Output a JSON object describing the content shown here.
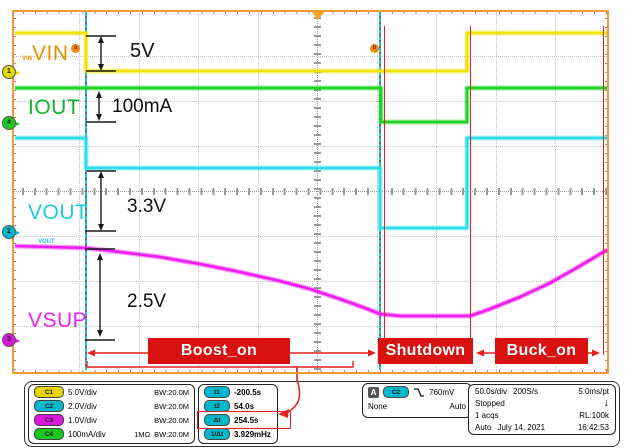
{
  "plot": {
    "channel_labels": {
      "c1": "VIN",
      "c4": "IOUT",
      "c2": "VOUT",
      "c3": "VSUP"
    },
    "tiny_labels": {
      "vin": "VIN",
      "vout": "VOUT"
    },
    "markers": {
      "a": "a",
      "b": "b"
    },
    "ground_markers": {
      "c1": "1",
      "c2": "2",
      "c3": "3",
      "c4": "4"
    },
    "measurements": {
      "vin_delta": "5V",
      "iout_delta": "100mA",
      "vout_delta": "3.3V",
      "vsup_delta": "2.5V"
    },
    "regions": {
      "boost": "Boost_on",
      "shutdown": "Shutdown",
      "buck": "Buck_on"
    },
    "colors": {
      "vin": "#f2e400",
      "iout": "#1ed321",
      "vout": "#2bdde8",
      "vsup": "#ee1cee",
      "annotation_red": "#e62020",
      "border_orange": "#ef9b3a"
    }
  },
  "waveforms": [
    {
      "name": "VIN",
      "color": "#f0e300",
      "points": [
        [
          3,
          23
        ],
        [
          74,
          23
        ],
        [
          74,
          61
        ],
        [
          455,
          61
        ],
        [
          455,
          23
        ],
        [
          596,
          23
        ]
      ]
    },
    {
      "name": "IOUT",
      "color": "#1ed321",
      "points": [
        [
          3,
          78
        ],
        [
          369,
          78
        ],
        [
          369,
          112
        ],
        [
          455,
          112
        ],
        [
          455,
          78
        ],
        [
          596,
          78
        ]
      ]
    },
    {
      "name": "VOUT",
      "color": "#2bdde8",
      "points": [
        [
          3,
          128
        ],
        [
          74,
          128
        ],
        [
          74,
          158
        ],
        [
          368,
          158
        ],
        [
          368,
          218
        ],
        [
          455,
          218
        ],
        [
          455,
          128
        ],
        [
          596,
          128
        ]
      ]
    },
    {
      "name": "VSUP",
      "color": "#ee1cee",
      "points": [
        [
          3,
          236
        ],
        [
          74,
          238
        ],
        [
          108,
          242
        ],
        [
          148,
          247
        ],
        [
          188,
          254
        ],
        [
          228,
          262
        ],
        [
          268,
          271
        ],
        [
          298,
          279
        ],
        [
          328,
          289
        ],
        [
          353,
          298
        ],
        [
          368,
          304
        ],
        [
          378,
          305
        ],
        [
          388,
          306
        ],
        [
          458,
          306
        ],
        [
          478,
          299
        ],
        [
          508,
          287
        ],
        [
          538,
          273
        ],
        [
          568,
          256
        ],
        [
          593,
          241
        ],
        [
          596,
          240
        ]
      ]
    }
  ],
  "geometry": {
    "cursors_x": [
      74,
      368
    ],
    "red_lines": [
      {
        "x": 372,
        "y1": 16,
        "y2": 345
      },
      {
        "x": 458,
        "y1": 16,
        "y2": 345
      },
      {
        "x": 591,
        "y1": 16,
        "y2": 345
      }
    ],
    "measures": [
      {
        "x": 89,
        "y1": 26,
        "y2": 61,
        "bars": [
          [
            74,
            104,
            26
          ],
          [
            74,
            104,
            61
          ]
        ]
      },
      {
        "x": 87,
        "y1": 81,
        "y2": 111,
        "bars": [
          [
            74,
            104,
            112
          ]
        ]
      },
      {
        "x": 89,
        "y1": 161,
        "y2": 221,
        "bars": [
          [
            75,
            104,
            161
          ],
          [
            73,
            104,
            221
          ]
        ]
      },
      {
        "x": 88,
        "y1": 243,
        "y2": 327,
        "bars": [
          [
            73,
            103,
            239
          ],
          [
            73,
            103,
            330
          ]
        ]
      }
    ],
    "red_arrows": [
      {
        "x1": 75,
        "x2": 364,
        "y": 343
      },
      {
        "x1": 464,
        "x2": 588,
        "y": 343
      }
    ],
    "bracket": {
      "pts": [
        [
          75,
          351
        ],
        [
          75,
          357
        ],
        [
          341,
          357
        ],
        [
          341,
          351
        ]
      ],
      "pointer": [
        [
          285,
          357
        ],
        [
          285,
          364
        ]
      ]
    }
  },
  "readouts": {
    "channels": [
      {
        "badge": "C1",
        "scale": "5.0V/div",
        "impedance": "",
        "bw": "BW:20.0M"
      },
      {
        "badge": "C2",
        "scale": "2.0V/div",
        "impedance": "",
        "bw": "BW:20.0M"
      },
      {
        "badge": "C3",
        "scale": "1.0V/div",
        "impedance": "",
        "bw": "BW:20.0M"
      },
      {
        "badge": "C4",
        "scale": "100mA/div",
        "impedance": "1MΩ",
        "bw": "BW:20.0M"
      }
    ],
    "cursors": [
      {
        "badge": "t1",
        "value": "-200.5s"
      },
      {
        "badge": "t2",
        "value": "54.0s"
      },
      {
        "badge": "Δt",
        "value": "254.5s"
      },
      {
        "badge": "1/Δt",
        "value": "3.929mHz"
      }
    ],
    "trigger": {
      "label": "A",
      "source": "C2",
      "level": "760mV",
      "mode": "None",
      "status": "Auto"
    },
    "horizontal": {
      "scale": "50.0s/div",
      "rate": "200S/s",
      "resolution": "5.0ms/pt",
      "state": "Stopped",
      "state_icon": "↓",
      "acquisitions": "1 acqs",
      "record_length": "RL:100k",
      "mode": "Auto",
      "date": "July 14, 2021",
      "time": "16:42:53"
    }
  }
}
